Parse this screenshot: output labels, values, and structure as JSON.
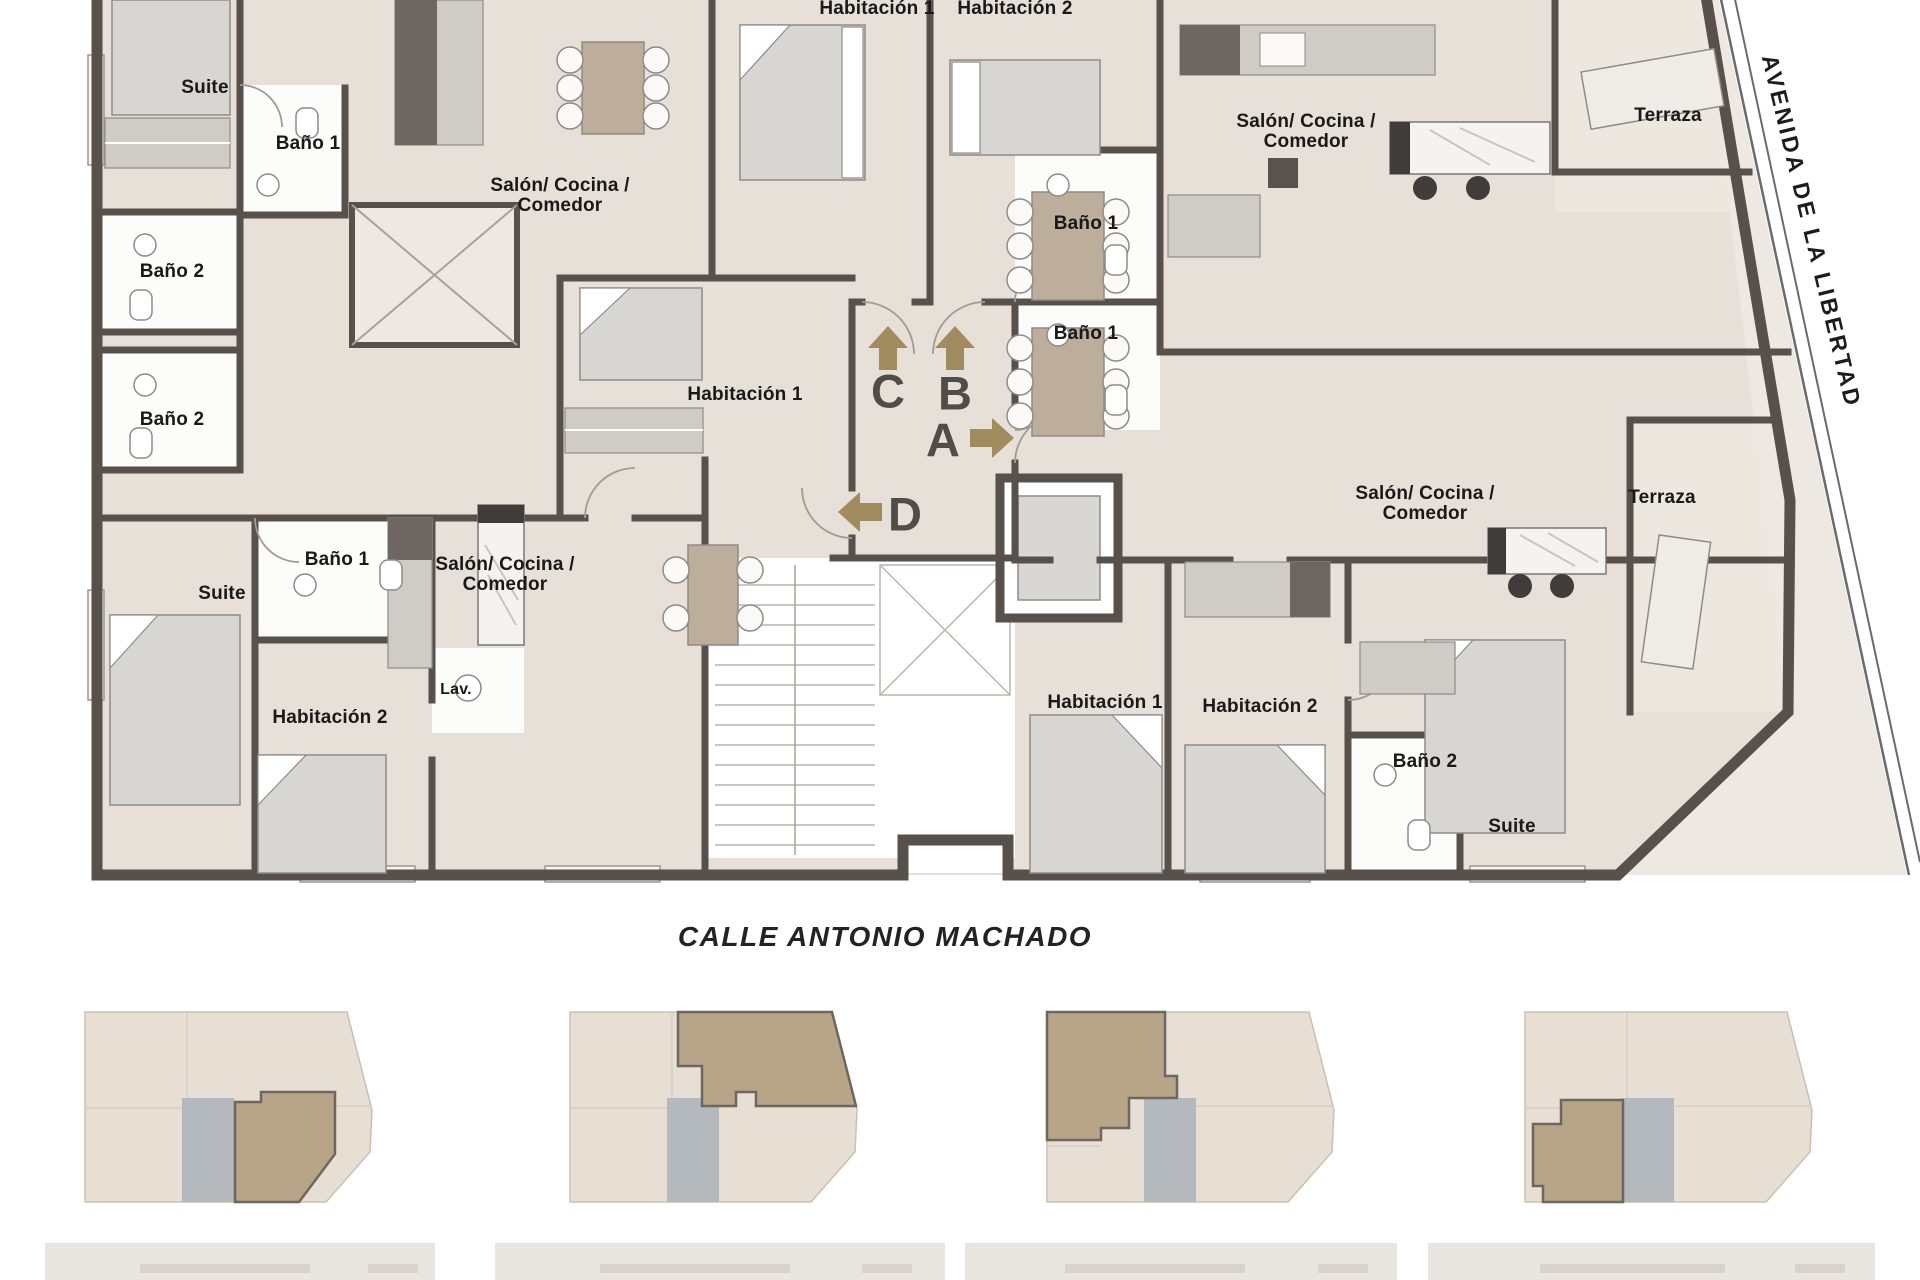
{
  "streets": {
    "bottom": "CALLE ANTONIO MACHADO",
    "right": "AVENIDA DE LA LIBERTAD"
  },
  "units": {
    "a": "A",
    "b": "B",
    "c": "C",
    "d": "D"
  },
  "rooms": {
    "suite": "Suite",
    "bano1": "Baño 1",
    "bano2": "Baño 2",
    "hab1": "Habitación 1",
    "hab2": "Habitación 2",
    "salon_line1": "Salón/ Cocina /",
    "salon_line2": "Comedor",
    "terraza": "Terraza",
    "lav": "Lav."
  },
  "colors": {
    "wall": "#57504B",
    "floor": "#E6E0D8",
    "terrace_floor": "#ECE7DF",
    "arrow": "#A08C5F",
    "unit_letter": "#504D47",
    "keyplan_fill": "#E7DFD4",
    "keyplan_highlight": "#B8A588",
    "keyplan_core": "#B4B9BE"
  }
}
